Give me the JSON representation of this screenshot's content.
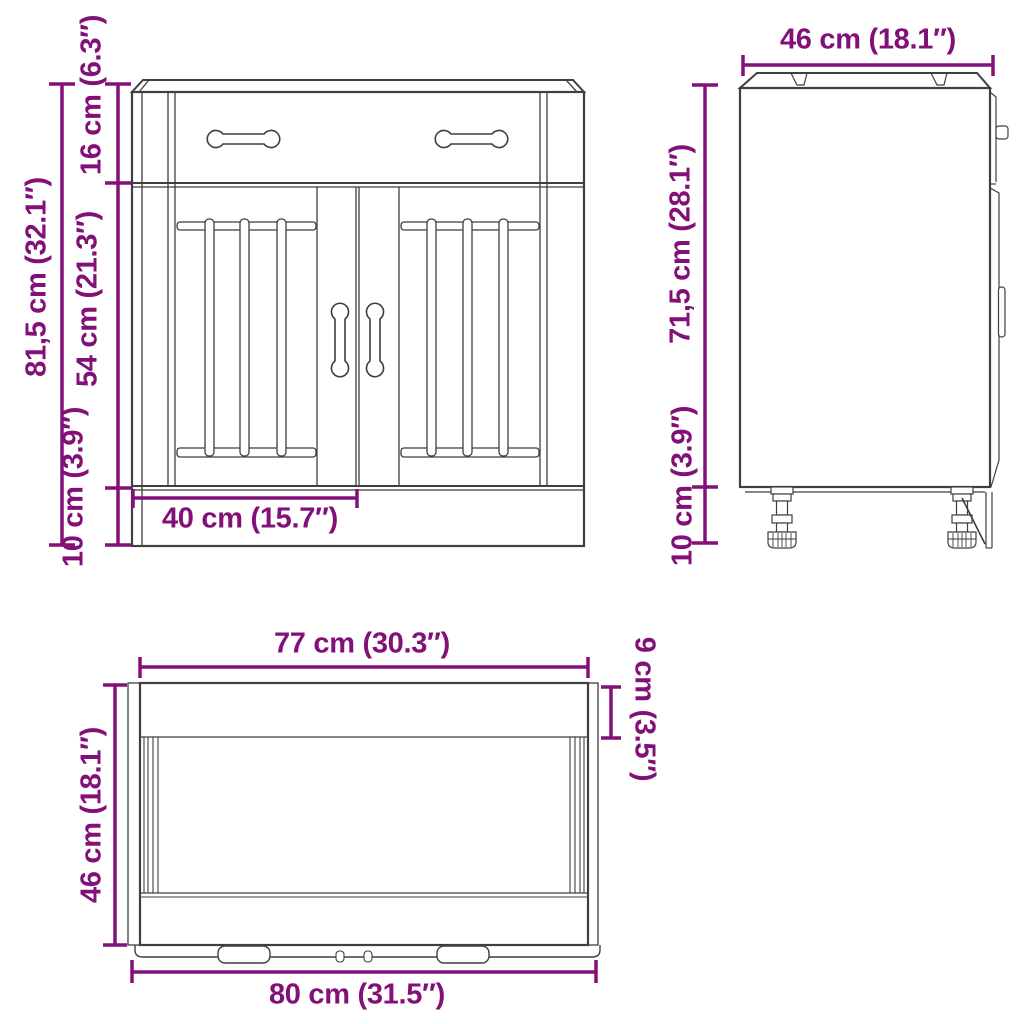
{
  "colors": {
    "dimension_accent": "#821078",
    "line_art": "#3f3f3f",
    "background": "#ffffff"
  },
  "views": {
    "front": {
      "total_height": "81,5 cm (32.1″)",
      "drawer_height": "16 cm (6.3″)",
      "door_height": "54 cm (21.3″)",
      "plinth_height": "10 cm (3.9″)",
      "door_width": "40 cm (15.7″)"
    },
    "side": {
      "depth": "46 cm (18.1″)",
      "body_height": "71,5 cm (28.1″)",
      "leg_height": "10 cm (3.9″)"
    },
    "top": {
      "inner_width": "77 cm (30.3″)",
      "top_rail_depth": "9 cm (3.5″)",
      "depth": "46 cm (18.1″)",
      "total_width": "80 cm (31.5″)"
    }
  }
}
